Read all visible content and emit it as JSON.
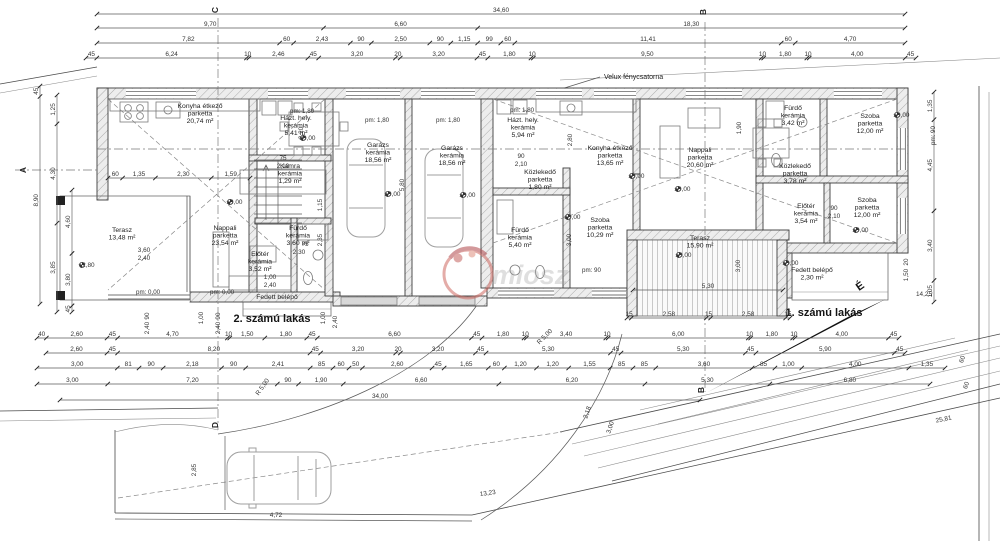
{
  "title_labels": {
    "apartment_left": "2. számú lakás",
    "apartment_right": "1. számú lakás",
    "velux_note": "Velux fénycsatorna",
    "north_letter": "É",
    "watermark_text": "miosz"
  },
  "colors": {
    "line": "#3f3f3f",
    "dim": "#4b4b4b",
    "wall_hatch": "#9a9a9a",
    "velux_fill": "#d2d2d2",
    "car": "#a9a9a9",
    "deck": "#bdbdbd",
    "watermark_red": "#c4625f",
    "watermark_gray": "#9e9e9e"
  },
  "rooms": [
    {
      "id": "konyha-etkezo-l",
      "lines": [
        "Konyha étkező",
        "parketta",
        "20,74 m²"
      ],
      "x": 200,
      "y": 108
    },
    {
      "id": "hazt-hely-l",
      "lines": [
        "Házt. hely.",
        "kerámia",
        "5,41 m²"
      ],
      "x": 296,
      "y": 120
    },
    {
      "id": "kamra-l",
      "lines": [
        "Kamra",
        "kerámia",
        "1,29 m²"
      ],
      "x": 290,
      "y": 168
    },
    {
      "id": "nappali-l",
      "lines": [
        "Nappali",
        "parketta",
        "23,54 m²"
      ],
      "x": 225,
      "y": 230
    },
    {
      "id": "terasz-l",
      "lines": [
        "Terasz",
        "13,48 m²"
      ],
      "x": 122,
      "y": 232
    },
    {
      "id": "furdo-l",
      "lines": [
        "Fürdő",
        "kerámia",
        "3,60 m²"
      ],
      "x": 298,
      "y": 230
    },
    {
      "id": "eloter-l",
      "lines": [
        "Előtér",
        "kerámia",
        "3,52 m²"
      ],
      "x": 260,
      "y": 256
    },
    {
      "id": "fedett-belepo-l",
      "lines": [
        "Fedett belépő"
      ],
      "x": 277,
      "y": 299
    },
    {
      "id": "garazs-1",
      "lines": [
        "Garázs",
        "kerámia",
        "18,56 m²"
      ],
      "x": 378,
      "y": 147
    },
    {
      "id": "garazs-2",
      "lines": [
        "Garázs",
        "kerámia",
        "18,56 m²"
      ],
      "x": 452,
      "y": 150
    },
    {
      "id": "hazt-hely-r",
      "lines": [
        "Házt. hely.",
        "kerámia",
        "5,94 m²"
      ],
      "x": 523,
      "y": 122
    },
    {
      "id": "konyha-etkezo-r",
      "lines": [
        "Konyha étkező",
        "parketta",
        "13,65 m²"
      ],
      "x": 610,
      "y": 150
    },
    {
      "id": "kozlekedo-r1",
      "lines": [
        "Közlekedő",
        "parketta",
        "1,80 m²"
      ],
      "x": 540,
      "y": 174
    },
    {
      "id": "nappali-r",
      "lines": [
        "Nappali",
        "parketta",
        "20,60 m²"
      ],
      "x": 700,
      "y": 152
    },
    {
      "id": "furdo-r1",
      "lines": [
        "Fürdő",
        "kerámia",
        "5,40 m²"
      ],
      "x": 520,
      "y": 232
    },
    {
      "id": "szoba-r1",
      "lines": [
        "Szoba",
        "parketta",
        "10,29 m²"
      ],
      "x": 600,
      "y": 222
    },
    {
      "id": "furdo-r2",
      "lines": [
        "Fürdő",
        "kerámia",
        "3,42 m²"
      ],
      "x": 793,
      "y": 110
    },
    {
      "id": "kozlekedo-r2",
      "lines": [
        "Közlekedő",
        "parketta",
        "3,78 m²"
      ],
      "x": 795,
      "y": 168
    },
    {
      "id": "szoba-r2",
      "lines": [
        "Szoba",
        "parketta",
        "12,00 m²"
      ],
      "x": 870,
      "y": 118
    },
    {
      "id": "szoba-r3",
      "lines": [
        "Szoba",
        "parketta",
        "12,00 m²"
      ],
      "x": 867,
      "y": 202
    },
    {
      "id": "eloter-r",
      "lines": [
        "Előtér",
        "kerámia",
        "3,54 m²"
      ],
      "x": 806,
      "y": 208
    },
    {
      "id": "terasz-r",
      "lines": [
        "Terasz",
        "15,90 m²"
      ],
      "x": 700,
      "y": 240
    },
    {
      "id": "fedett-belepo-r",
      "lines": [
        "Fedett belépő",
        "2,30 m²"
      ],
      "x": 812,
      "y": 272
    }
  ],
  "levels": [
    {
      "text": "±0,00",
      "x": 230,
      "y": 204
    },
    {
      "text": "±0,00",
      "x": 303,
      "y": 140
    },
    {
      "text": "±0,00",
      "x": 388,
      "y": 196
    },
    {
      "text": "±0,00",
      "x": 463,
      "y": 197
    },
    {
      "text": "±0,00",
      "x": 632,
      "y": 178
    },
    {
      "text": "±0,00",
      "x": 678,
      "y": 191
    },
    {
      "text": "±0,00",
      "x": 897,
      "y": 117
    },
    {
      "text": "±0,00",
      "x": 856,
      "y": 232
    },
    {
      "text": "±0,00",
      "x": 568,
      "y": 219
    },
    {
      "text": "±0,00",
      "x": 679,
      "y": 257
    },
    {
      "text": "±0,00",
      "x": 786,
      "y": 265
    },
    {
      "text": "+2,80",
      "x": 82,
      "y": 267
    }
  ],
  "pm_labels": [
    {
      "text": "pm: 1,80",
      "x": 290,
      "y": 113
    },
    {
      "text": "pm: 1,80",
      "x": 365,
      "y": 122
    },
    {
      "text": "pm: 1,80",
      "x": 436,
      "y": 122
    },
    {
      "text": "pm: 1,80",
      "x": 510,
      "y": 112
    },
    {
      "text": "pm: 0,00",
      "x": 136,
      "y": 294
    },
    {
      "text": "pm: 0,00",
      "x": 210,
      "y": 294
    },
    {
      "text": "pm: 90",
      "x": 582,
      "y": 272
    },
    {
      "text": "pm: 90",
      "x": 935,
      "y": 145,
      "rot": -90
    }
  ],
  "dim_chains": [
    {
      "o": "h",
      "y": 14,
      "x0": 97,
      "x1": 905,
      "values": [
        "34,60"
      ]
    },
    {
      "o": "h",
      "y": 28,
      "x0": 97,
      "x1": 905,
      "values": [
        "9,70",
        "6,60",
        "18,30"
      ]
    },
    {
      "o": "h",
      "y": 43,
      "x0": 97,
      "x1": 905,
      "values": [
        "7,82",
        "60",
        "2,43",
        "90",
        "2,50",
        "90",
        "1,15",
        "99",
        "60",
        "11,41",
        "60",
        "4,70"
      ]
    },
    {
      "o": "h",
      "y": 58,
      "x0": 86,
      "x1": 916,
      "values": [
        "45",
        "6,24",
        "10",
        "2,46",
        "45",
        "3,20",
        "20",
        "3,20",
        "45",
        "1,80",
        "10",
        "9,50",
        "10",
        "1,80",
        "10",
        "4,00",
        "45"
      ]
    },
    {
      "o": "h",
      "y": 338,
      "x0": 37,
      "x1": 899,
      "values": [
        "40",
        "2,60",
        "45",
        "4,70",
        "10",
        "1,50",
        "1,80",
        "45",
        "6,60",
        "45",
        "1,80",
        "10",
        "3,40",
        "10",
        "6,00",
        "10",
        "1,80",
        "10",
        "4,00",
        "45"
      ]
    },
    {
      "o": "h",
      "y": 353,
      "x0": 46,
      "x1": 905,
      "values": [
        "2,60",
        "45",
        "8,20",
        "45",
        "3,20",
        "20",
        "3,20",
        "45",
        "5,30",
        "45",
        "5,30",
        "45",
        "5,90",
        "45"
      ]
    },
    {
      "o": "h",
      "y": 368,
      "x0": 37,
      "x1": 945,
      "values": [
        "3,00",
        "81",
        "90",
        "2,18",
        "90",
        "2,41",
        "85",
        "60",
        "50",
        "2,60",
        "45",
        "1,65",
        "60",
        "1,20",
        "1,20",
        "1,55",
        "85",
        "85",
        "3,60",
        "85",
        "1,00",
        "4,00",
        "1,35"
      ]
    },
    {
      "o": "h",
      "y": 384,
      "x0": 37,
      "x1": 930,
      "values": [
        "3,00",
        "7,20",
        "90",
        "1,90",
        "6,60",
        "6,20",
        "5,30",
        "6,80"
      ]
    },
    {
      "o": "h",
      "y": 400,
      "x0": 60,
      "x1": 700,
      "values": [
        "34,00"
      ]
    },
    {
      "o": "h",
      "y": 178,
      "x0": 108,
      "x1": 250,
      "values": [
        "60",
        "1,35",
        "2,30",
        "1,59"
      ]
    },
    {
      "o": "h",
      "y": 318,
      "x0": 627,
      "x1": 790,
      "values": [
        "15",
        "2,58",
        "15",
        "2,58",
        "15"
      ]
    },
    {
      "o": "h",
      "y": 290,
      "x0": 633,
      "x1": 783,
      "values": [
        "5,30"
      ]
    },
    {
      "o": "v",
      "x": 40,
      "y0": 86,
      "y1": 304,
      "values": [
        "45",
        "8,90"
      ]
    },
    {
      "o": "v",
      "x": 57,
      "y0": 95,
      "y1": 312,
      "values": [
        "1,25",
        "4,30",
        "3,85"
      ]
    },
    {
      "o": "v",
      "x": 72,
      "y0": 190,
      "y1": 312,
      "values": [
        "4,60",
        "3,80",
        "45"
      ]
    },
    {
      "o": "v",
      "x": 934,
      "y0": 92,
      "y1": 302,
      "values": [
        "1,35",
        "4,45",
        "3,40",
        "1,05"
      ]
    }
  ],
  "free_dims": [
    {
      "t": "R 5,00",
      "x": 264,
      "y": 388,
      "r": -55
    },
    {
      "t": "R 5,00",
      "x": 546,
      "y": 338,
      "r": -45
    },
    {
      "t": "13,23",
      "x": 488,
      "y": 495,
      "r": -8
    },
    {
      "t": "4,72",
      "x": 276,
      "y": 517
    },
    {
      "t": "2,85",
      "x": 196,
      "y": 470,
      "r": -90
    },
    {
      "t": "25,81",
      "x": 944,
      "y": 421,
      "r": -12
    },
    {
      "t": "14,25",
      "x": 924,
      "y": 296
    },
    {
      "t": "2,18",
      "x": 589,
      "y": 413,
      "r": -72
    },
    {
      "t": "3,00",
      "x": 612,
      "y": 428,
      "r": -72
    },
    {
      "t": "60",
      "x": 964,
      "y": 360,
      "r": -70
    },
    {
      "t": "60",
      "x": 968,
      "y": 386,
      "r": -70
    },
    {
      "t": "3,60",
      "x": 144,
      "y": 252
    },
    {
      "t": "2,40",
      "x": 144,
      "y": 260
    },
    {
      "t": "1,00",
      "x": 270,
      "y": 279
    },
    {
      "t": "2,40",
      "x": 270,
      "y": 287
    },
    {
      "t": "90",
      "x": 521,
      "y": 158
    },
    {
      "t": "2,10",
      "x": 521,
      "y": 166
    },
    {
      "t": "90",
      "x": 834,
      "y": 210
    },
    {
      "t": "2,10",
      "x": 834,
      "y": 218
    },
    {
      "t": "75",
      "x": 305,
      "y": 246
    },
    {
      "t": "2,30",
      "x": 299,
      "y": 254
    },
    {
      "t": "75",
      "x": 283,
      "y": 160
    },
    {
      "t": "2,10",
      "x": 283,
      "y": 168
    },
    {
      "t": "2,20",
      "x": 303,
      "y": 133,
      "r": -90
    },
    {
      "t": "2,80",
      "x": 572,
      "y": 140,
      "r": -90
    },
    {
      "t": "1,90",
      "x": 741,
      "y": 128,
      "r": -90
    },
    {
      "t": "5,80",
      "x": 404,
      "y": 185,
      "r": -90
    },
    {
      "t": "3,00",
      "x": 571,
      "y": 240,
      "r": -90
    },
    {
      "t": "3,00",
      "x": 740,
      "y": 266,
      "r": -90
    },
    {
      "t": "1,15",
      "x": 322,
      "y": 205,
      "r": -90
    },
    {
      "t": "2,35",
      "x": 322,
      "y": 240,
      "r": -90
    },
    {
      "t": "90",
      "x": 149,
      "y": 316,
      "r": -90
    },
    {
      "t": "2,40",
      "x": 149,
      "y": 328,
      "r": -90
    },
    {
      "t": "1,00",
      "x": 203,
      "y": 318,
      "r": -90
    },
    {
      "t": "90",
      "x": 220,
      "y": 316,
      "r": -90
    },
    {
      "t": "2,40",
      "x": 220,
      "y": 328,
      "r": -90
    },
    {
      "t": "1,00",
      "x": 325,
      "y": 318,
      "r": -90
    },
    {
      "t": "2,40",
      "x": 337,
      "y": 322,
      "r": -90
    },
    {
      "t": "20",
      "x": 908,
      "y": 262,
      "r": -90
    },
    {
      "t": "1,50",
      "x": 908,
      "y": 275,
      "r": -90
    }
  ],
  "section_markers": [
    {
      "label": "C",
      "x": 218,
      "y": 10
    },
    {
      "label": "B",
      "x": 706,
      "y": 12
    },
    {
      "label": "A",
      "x": 26,
      "y": 170
    },
    {
      "label": "D",
      "x": 218,
      "y": 425
    },
    {
      "label": "B",
      "x": 704,
      "y": 390
    }
  ]
}
